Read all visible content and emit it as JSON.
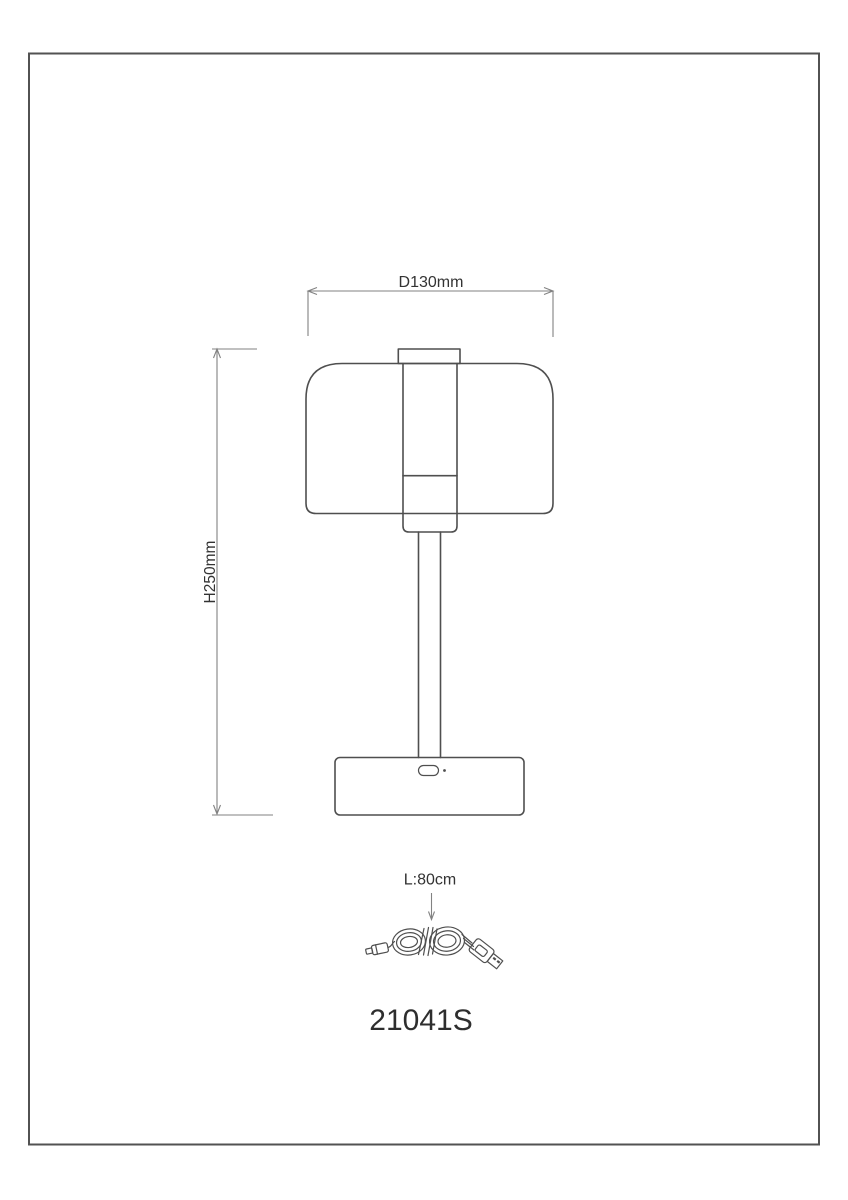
{
  "drawing": {
    "model_number": "21041S",
    "annotations": {
      "diameter": "D130mm",
      "height": "H250mm",
      "cable_length": "L:80cm"
    },
    "colors": {
      "background": "#ffffff",
      "frame_border": "#525252",
      "object_line": "#4f4f4f",
      "dimension_line": "#828282",
      "label_text": "#333333"
    }
  }
}
